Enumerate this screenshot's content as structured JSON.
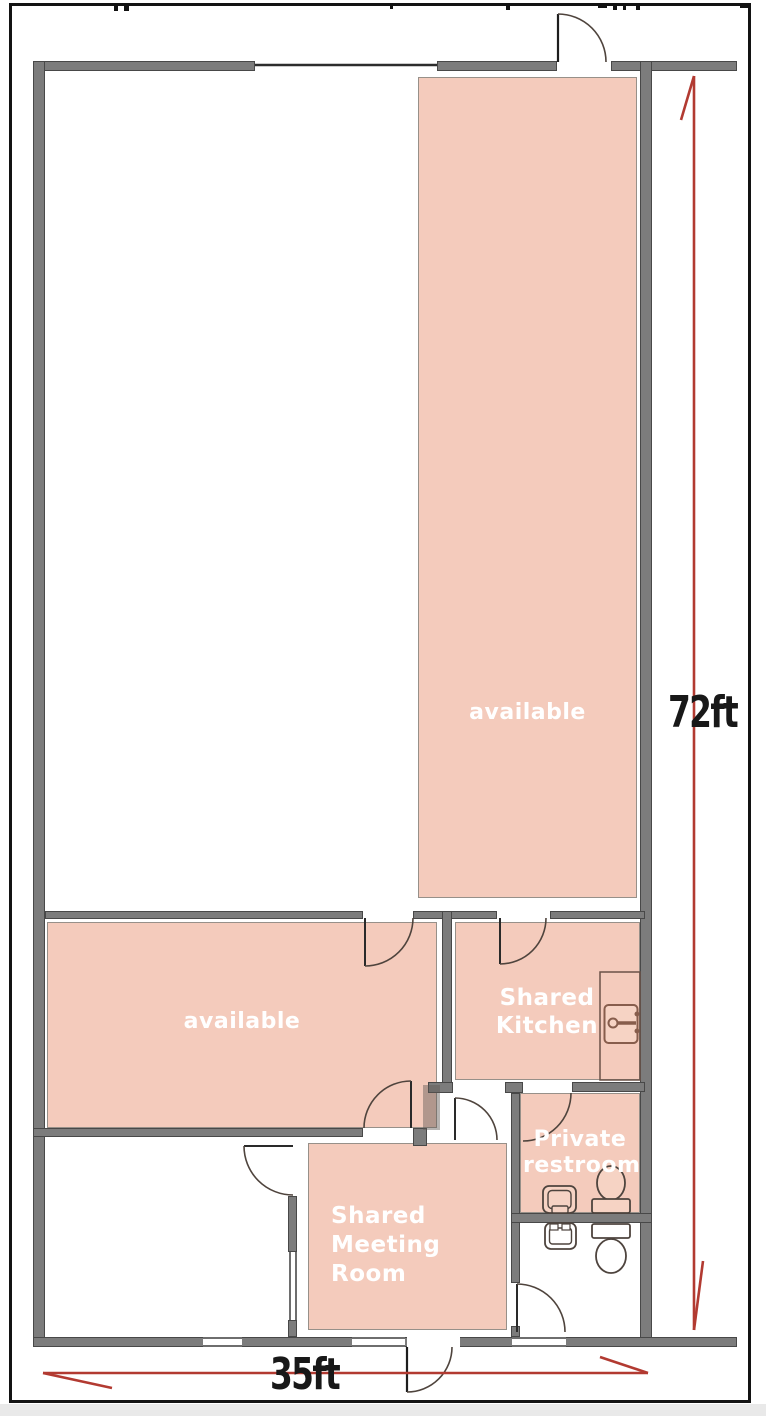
{
  "floor_plan": {
    "rooms": [
      {
        "name": "available-tall",
        "label": "available"
      },
      {
        "name": "available-left",
        "label": "available"
      },
      {
        "name": "shared-kitchen",
        "label": "Shared Kitchen"
      },
      {
        "name": "private-restroom",
        "label": "Private restroom"
      },
      {
        "name": "shared-meeting-room",
        "label": "Shared Meeting Room"
      }
    ],
    "dimensions": {
      "height": "72ft",
      "width": "35ft"
    },
    "fixtures": [
      "kitchen-counter",
      "kitchen-sink-icon",
      "private-restroom-sink-icon",
      "private-restroom-toilet-icon",
      "lower-restroom-sink-icon",
      "lower-restroom-toilet-icon"
    ],
    "colors": {
      "room_fill": "#f4cbbc",
      "wall_gray": "#7c7c7c",
      "dimension_red": "#b23a31",
      "fixture_brown": "#875d4c",
      "label_text": "#ffffff",
      "dimension_text": "#1a1a1a",
      "frame_black": "#131313"
    }
  }
}
